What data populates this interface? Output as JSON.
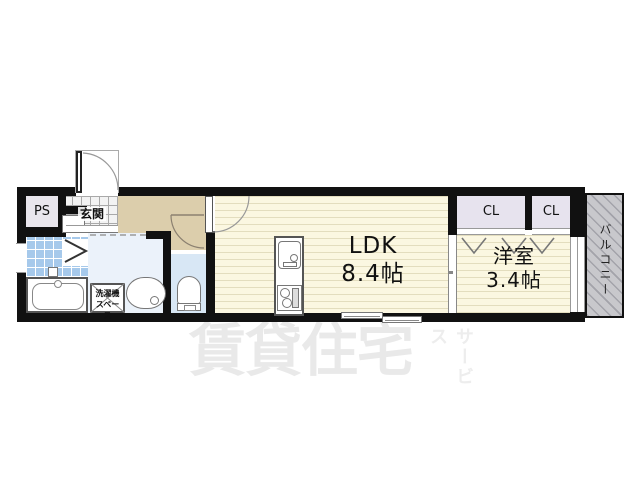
{
  "watermark": {
    "main": "賃貸住宅",
    "sub": "サービス"
  },
  "rooms": {
    "ldk": {
      "name": "LDK",
      "size": "8.4帖"
    },
    "western_room": {
      "name": "洋室",
      "size": "3.4帖"
    },
    "entrance": {
      "label": "玄関"
    },
    "pipe_space": {
      "label": "PS"
    },
    "closet_left": {
      "label": "CL"
    },
    "closet_right": {
      "label": "CL"
    },
    "balcony": {
      "label": "バルコニー"
    },
    "laundry_space": {
      "label_line1": "洗濯機",
      "label_line2": "スペース"
    }
  },
  "colors": {
    "wall": "#111111",
    "floor_cream": "#FBF7E1",
    "floor_stripe": "#E3DDBE",
    "hallway_tan": "#DCCEAC",
    "bath_tile_blue": "#A6C9EB",
    "washroom_blue": "#EBF2FA",
    "toilet_blue": "#D8E7F5",
    "closet_lavender": "#E7E3EE",
    "ps_gray": "#E9E6ED",
    "balcony_gray": "#C8C8CC",
    "watermark_gray": "#E9E9E9"
  }
}
